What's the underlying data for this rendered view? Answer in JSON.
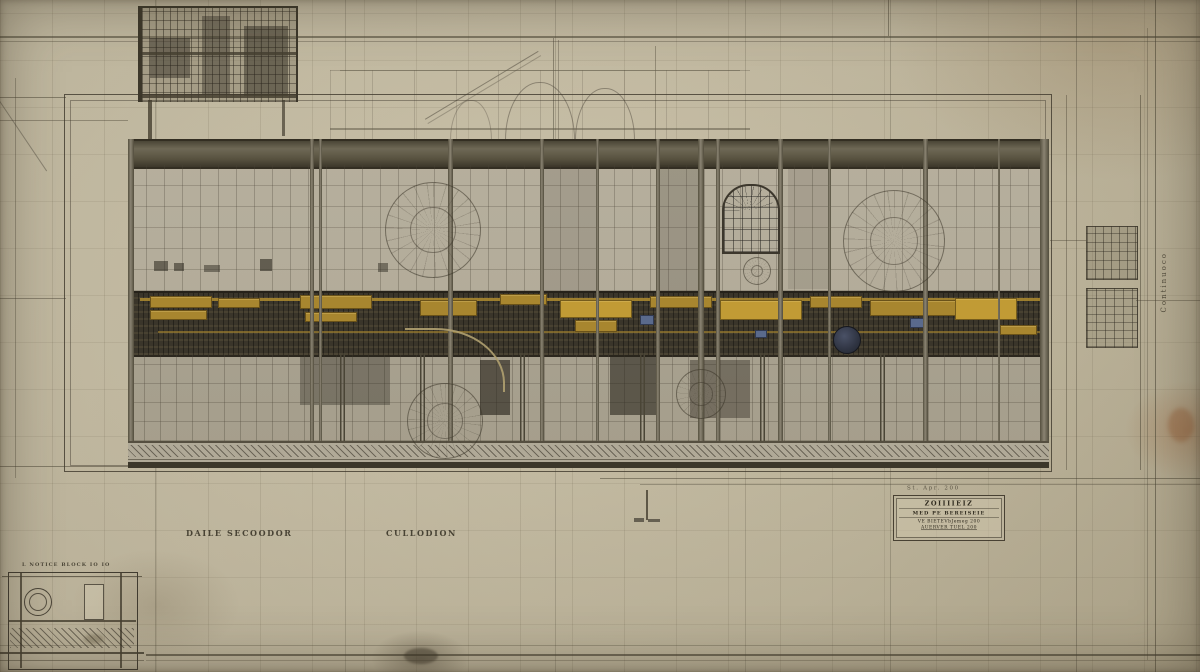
{
  "sheet": {
    "kind": "antique engineering drawing — longitudinal section of an engine hall",
    "palette": {
      "paper": "#c5bca3",
      "paper_shadow": "#a89f86",
      "ink": "#453f30",
      "panel": "#b4ad9b",
      "machinery_band": "#3a352a",
      "accent_yellow": "#a8862f",
      "accent_yellow_bright": "#c19b35",
      "glass_blue": "#7e8499",
      "flywheel_blue": "#2f3442"
    }
  },
  "captions": {
    "left": "DAILE SECOODOR",
    "center": "CULLODION",
    "corner_detail": "L NOTICE BLOCK IO IO"
  },
  "title_block": {
    "above": "St. Apr. 200",
    "line1": "ZOIIIIEIZ",
    "line2": "MED PE BEREISEIE",
    "line3": "VE BIETEVbJemeg 200",
    "line4": "AUERVER TUEL 200"
  },
  "margin_note_vertical": "Continuoco"
}
